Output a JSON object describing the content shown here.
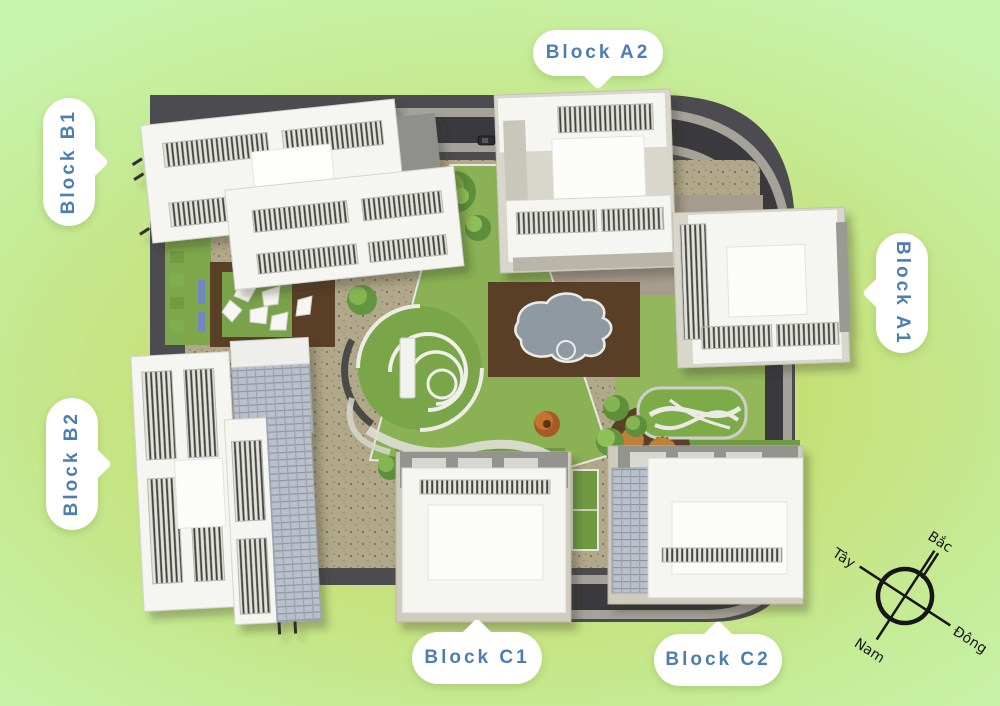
{
  "callouts": {
    "a2": {
      "label": "Block A2"
    },
    "a1": {
      "label": "Block A1"
    },
    "b1": {
      "label": "Block B1"
    },
    "b2": {
      "label": "Block B2"
    },
    "c1": {
      "label": "Block C1"
    },
    "c2": {
      "label": "Block C2"
    }
  },
  "compass": {
    "north": "Bắc",
    "south": "Nam",
    "east": "Đông",
    "west": "Tây"
  },
  "colors": {
    "background_center": "#c9dc5e",
    "background_edge": "#c8f4ad",
    "callout_text": "#4d7eb2",
    "callout_fill": "#ffffff",
    "site_base": "#4c4c50",
    "road_asphalt": "#3a3a3e",
    "sidewalk": "#a5a29a",
    "paving": "#b1a78a",
    "lawn": "#82aa4e",
    "wood_deck": "#5a3f27",
    "pool_water": "#8f99a2",
    "building_white": "#f5f5f2",
    "compass_ink": "#161616"
  }
}
